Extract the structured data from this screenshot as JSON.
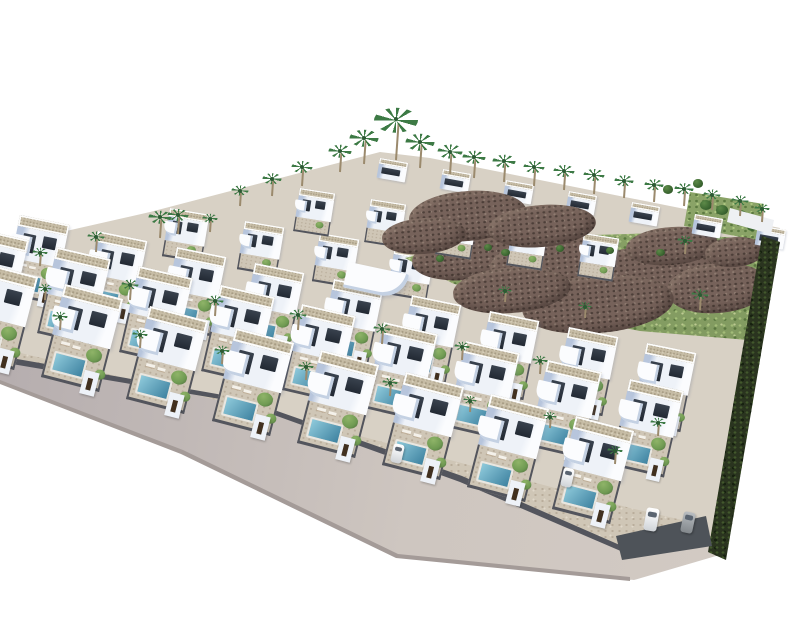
{
  "meta": {
    "type": "architectural-aerial-3d-render",
    "subject": "hillside residential development of white modern villas with private pools, palm trees, access road and undeveloped green rocky slope"
  },
  "scene": {
    "canvas": {
      "width": 800,
      "height": 640
    },
    "colors": {
      "background": "#ffffff",
      "villa-white": "#eef2f8",
      "villa-bright": "#fbfcfe",
      "villa-shadow": "#cdd7e8",
      "villa-shadow2": "#b7c5dc",
      "window-dark": "#222933",
      "roof-beige": "#c6bca5",
      "roof-speck": "#a89d85",
      "garden-tan": "#cfc6b6",
      "garden-speck": "#b9ad9b",
      "pool-light": "#8fcadb",
      "pool-deep": "#3e82a0",
      "fence-dark": "#53555d",
      "gate-door": "#41301f",
      "road-light": "#cec6c0",
      "road-dark": "#b2aaac",
      "curb": "#a49b98",
      "hill-green": "#8aa367",
      "hill-speck-light": "#aec881",
      "hill-speck-dark": "#5c7a41",
      "rock-main": "#76625a",
      "rock-dark": "#4d3f39",
      "rock-light": "#8f7c71",
      "palm-green": "#3d7a45",
      "palm-trunk": "#9b8a6d",
      "hedge-dark": "#2a341f",
      "hedge-speck": "#42582c",
      "wall-gray": "#4e5359",
      "wall-white": "#eef0f3",
      "tree-green": "#6f9a52",
      "car-white": "#eceef0",
      "car-gray": "#9fa4a8",
      "shadow-blue": "rgba(90,104,138,0.22)"
    },
    "villa_rows": [
      {
        "name": "ridge-row",
        "variant": "ridge",
        "x": 380,
        "y": 158,
        "angle": 10,
        "scale": 0.62,
        "count": 7,
        "spacing": 64,
        "z": 15
      },
      {
        "name": "row-5",
        "variant": "back",
        "x": 300,
        "y": 188,
        "angle": 9,
        "scale": 0.66,
        "count": 5,
        "spacing": 72,
        "z": 14
      },
      {
        "name": "row-4",
        "variant": "back",
        "x": 170,
        "y": 208,
        "angle": 9.5,
        "scale": 0.74,
        "count": 6,
        "spacing": 76,
        "z": 12
      },
      {
        "name": "row-3",
        "variant": "front",
        "x": 20,
        "y": 215,
        "angle": 11.5,
        "scale": 0.84,
        "count": 9,
        "spacing": 80,
        "z": 18
      },
      {
        "name": "row-2",
        "variant": "front",
        "x": -25,
        "y": 228,
        "angle": 13,
        "scale": 0.92,
        "count": 9,
        "spacing": 84,
        "z": 20
      },
      {
        "name": "row-1",
        "variant": "front",
        "x": -20,
        "y": 262,
        "angle": 14.5,
        "scale": 1.0,
        "count": 8,
        "spacing": 88,
        "z": 22
      }
    ],
    "palms": [
      [
        396,
        160,
        46
      ],
      [
        364,
        164,
        30
      ],
      [
        340,
        172,
        24
      ],
      [
        420,
        168,
        30
      ],
      [
        450,
        174,
        26
      ],
      [
        474,
        178,
        24
      ],
      [
        504,
        182,
        24
      ],
      [
        534,
        186,
        22
      ],
      [
        564,
        190,
        22
      ],
      [
        594,
        194,
        22
      ],
      [
        624,
        198,
        20
      ],
      [
        654,
        202,
        20
      ],
      [
        684,
        206,
        20
      ],
      [
        712,
        210,
        18
      ],
      [
        740,
        216,
        18
      ],
      [
        762,
        222,
        16
      ],
      [
        302,
        186,
        22
      ],
      [
        272,
        196,
        20
      ],
      [
        240,
        206,
        18
      ],
      [
        160,
        238,
        24
      ],
      [
        178,
        234,
        22
      ],
      [
        96,
        252,
        18
      ],
      [
        40,
        266,
        16
      ],
      [
        210,
        232,
        16
      ],
      [
        130,
        300,
        18
      ],
      [
        215,
        316,
        18
      ],
      [
        298,
        330,
        18
      ],
      [
        382,
        344,
        18
      ],
      [
        462,
        360,
        16
      ],
      [
        540,
        374,
        16
      ],
      [
        60,
        330,
        16
      ],
      [
        140,
        348,
        16
      ],
      [
        222,
        364,
        16
      ],
      [
        306,
        380,
        16
      ],
      [
        390,
        396,
        16
      ],
      [
        470,
        412,
        14
      ],
      [
        550,
        428,
        14
      ],
      [
        615,
        464,
        16
      ],
      [
        658,
        436,
        16
      ],
      [
        700,
        310,
        18
      ],
      [
        685,
        254,
        16
      ],
      [
        45,
        300,
        14
      ],
      [
        585,
        318,
        14
      ],
      [
        505,
        302,
        14
      ]
    ],
    "rocks": [
      [
        468,
        258,
        112,
        44,
        13
      ],
      [
        556,
        264,
        132,
        56,
        13
      ],
      [
        648,
        276,
        142,
        60,
        13
      ],
      [
        718,
        288,
        102,
        50,
        13
      ],
      [
        598,
        304,
        152,
        58,
        13
      ],
      [
        512,
        290,
        118,
        46,
        13
      ],
      [
        672,
        246,
        92,
        38,
        13
      ],
      [
        735,
        252,
        60,
        30,
        13
      ],
      [
        468,
        216,
        118,
        50,
        16
      ],
      [
        542,
        226,
        108,
        42,
        16
      ],
      [
        424,
        236,
        84,
        36,
        16
      ]
    ],
    "shrubs": [
      [
        706,
        206,
        12
      ],
      [
        722,
        211,
        12
      ],
      [
        740,
        217,
        14
      ],
      [
        698,
        184,
        10
      ],
      [
        668,
        190,
        10
      ],
      [
        752,
        227,
        10
      ],
      [
        505,
        253,
        9
      ],
      [
        560,
        249,
        8
      ],
      [
        610,
        251,
        8
      ],
      [
        660,
        253,
        9
      ],
      [
        440,
        259,
        8
      ],
      [
        488,
        248,
        8
      ]
    ],
    "cars": [
      {
        "x": 645,
        "y": 508,
        "w": 13,
        "h": 23,
        "angle": 10,
        "tone": "white"
      },
      {
        "x": 682,
        "y": 512,
        "w": 12,
        "h": 21,
        "angle": 12,
        "tone": "gray"
      },
      {
        "x": 392,
        "y": 444,
        "w": 11,
        "h": 19,
        "angle": 13,
        "tone": "white"
      },
      {
        "x": 562,
        "y": 468,
        "w": 11,
        "h": 19,
        "angle": 13,
        "tone": "white"
      }
    ]
  }
}
